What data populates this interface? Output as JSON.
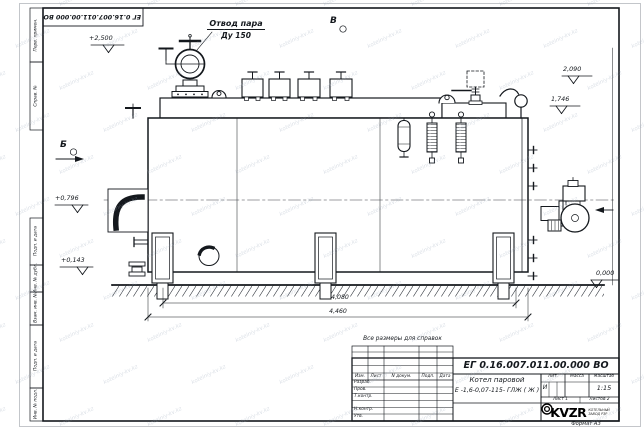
{
  "watermark": {
    "text": "kotelniy-kv.kz"
  },
  "frame": {
    "top_stamp": "ЕГ 0.16.007.011.00.000  ВО",
    "left_fields": [
      "Перв. примен.",
      "Справ. №",
      "Подп. и дата",
      "Инв. № дубл.",
      "Взам. инв. №",
      "Подп. и дата",
      "Инв. № подл."
    ]
  },
  "annotations": {
    "steam_outlet_1": "Отвод пара",
    "steam_outlet_2": "Ду 150",
    "view_top": "В",
    "view_left": "Б",
    "elev_plus_2500": "+2,500",
    "elev_2090": "2,090",
    "elev_1746": "1,746",
    "elev_plus_0796": "+0,796",
    "elev_plus_0143": "+0,143",
    "elev_zero": "0,000",
    "dim_length_inner": "4,080",
    "dim_length_outer": "4,460",
    "note": "Все размеры для справок"
  },
  "title_block": {
    "doc_number": "ЕГ 0.16.007.011.00.000  ВО",
    "product_line1": "Котел паровой",
    "product_line2": "Е -1,6-0,07-115- ГЛЖ ( Ж )",
    "col_izm": "Изм.",
    "col_list": "Лист",
    "col_doc": "N докум.",
    "col_podp": "Подп.",
    "col_data": "Дата",
    "row_razrab": "Разраб.",
    "row_prov": "Пров.",
    "row_tkontr": "Т.контр.",
    "row_nkontr": "Н.контр.",
    "row_utv": "Утв.",
    "lit_label": "Лит.",
    "mass_label": "Масса",
    "scale_label": "Масштаб",
    "lit_value": "И",
    "scale_value": "1:15",
    "sheet_label": "Лист 1",
    "sheets_label": "Листов 2",
    "logo_text": "KVZR",
    "logo_sub1": "КОТЕЛЬНЫЙ",
    "logo_sub2": "ЗАВОД РЗР",
    "format_label": "Формат А3"
  }
}
